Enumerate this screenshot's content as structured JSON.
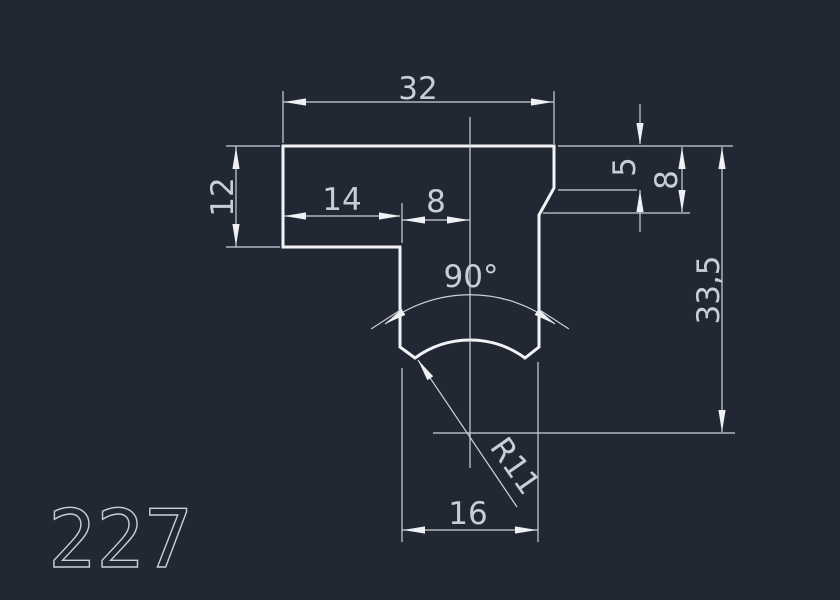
{
  "canvas": {
    "background_color": "#222734",
    "outline_color": "#f2f3f5",
    "dimension_line_color": "#ccd1d9",
    "text_color": "#c9ced6"
  },
  "drawing": {
    "number": "227",
    "dimensions": {
      "overall_width": "32",
      "left_flange_thickness": "12",
      "left_offset": "14",
      "stem_edge_to_center": "8",
      "right_chamfer_start_depth": "5",
      "right_flange_thickness": "8",
      "overall_height": "33,5",
      "groove_angle": "90°",
      "groove_radius": "R11",
      "stem_width": "16"
    }
  }
}
